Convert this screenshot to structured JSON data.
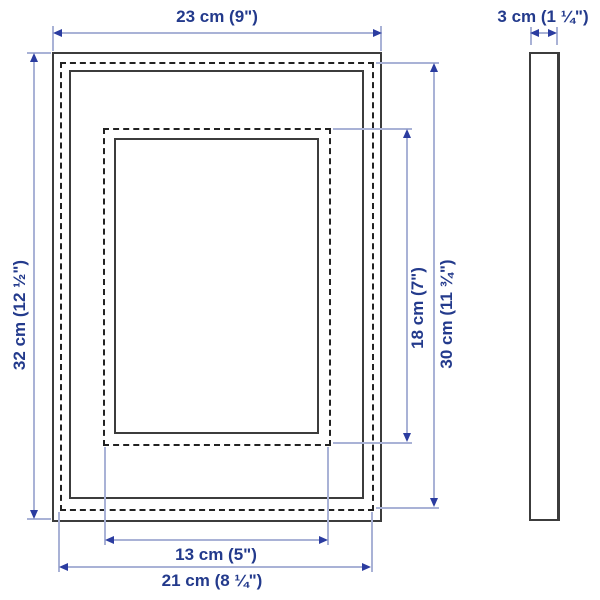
{
  "dimensions": {
    "frame_width": "23 cm (9\")",
    "frame_height": "32 cm (12 ½\")",
    "opening_width": "13 cm (5\")",
    "opening_height": "18 cm (7\")",
    "picture_width": "21 cm (8 ¼\")",
    "picture_height": "30 cm (11 ¾\")",
    "depth": "3 cm (1 ¼\")"
  },
  "colors": {
    "dimension_text": "#233a8c",
    "dimension_line": "#a9b2d6",
    "arrow_head": "#2b3ca0",
    "frame_solid_line": "#3c3c3c",
    "frame_dashed_line": "#222222",
    "background": "#ffffff"
  }
}
